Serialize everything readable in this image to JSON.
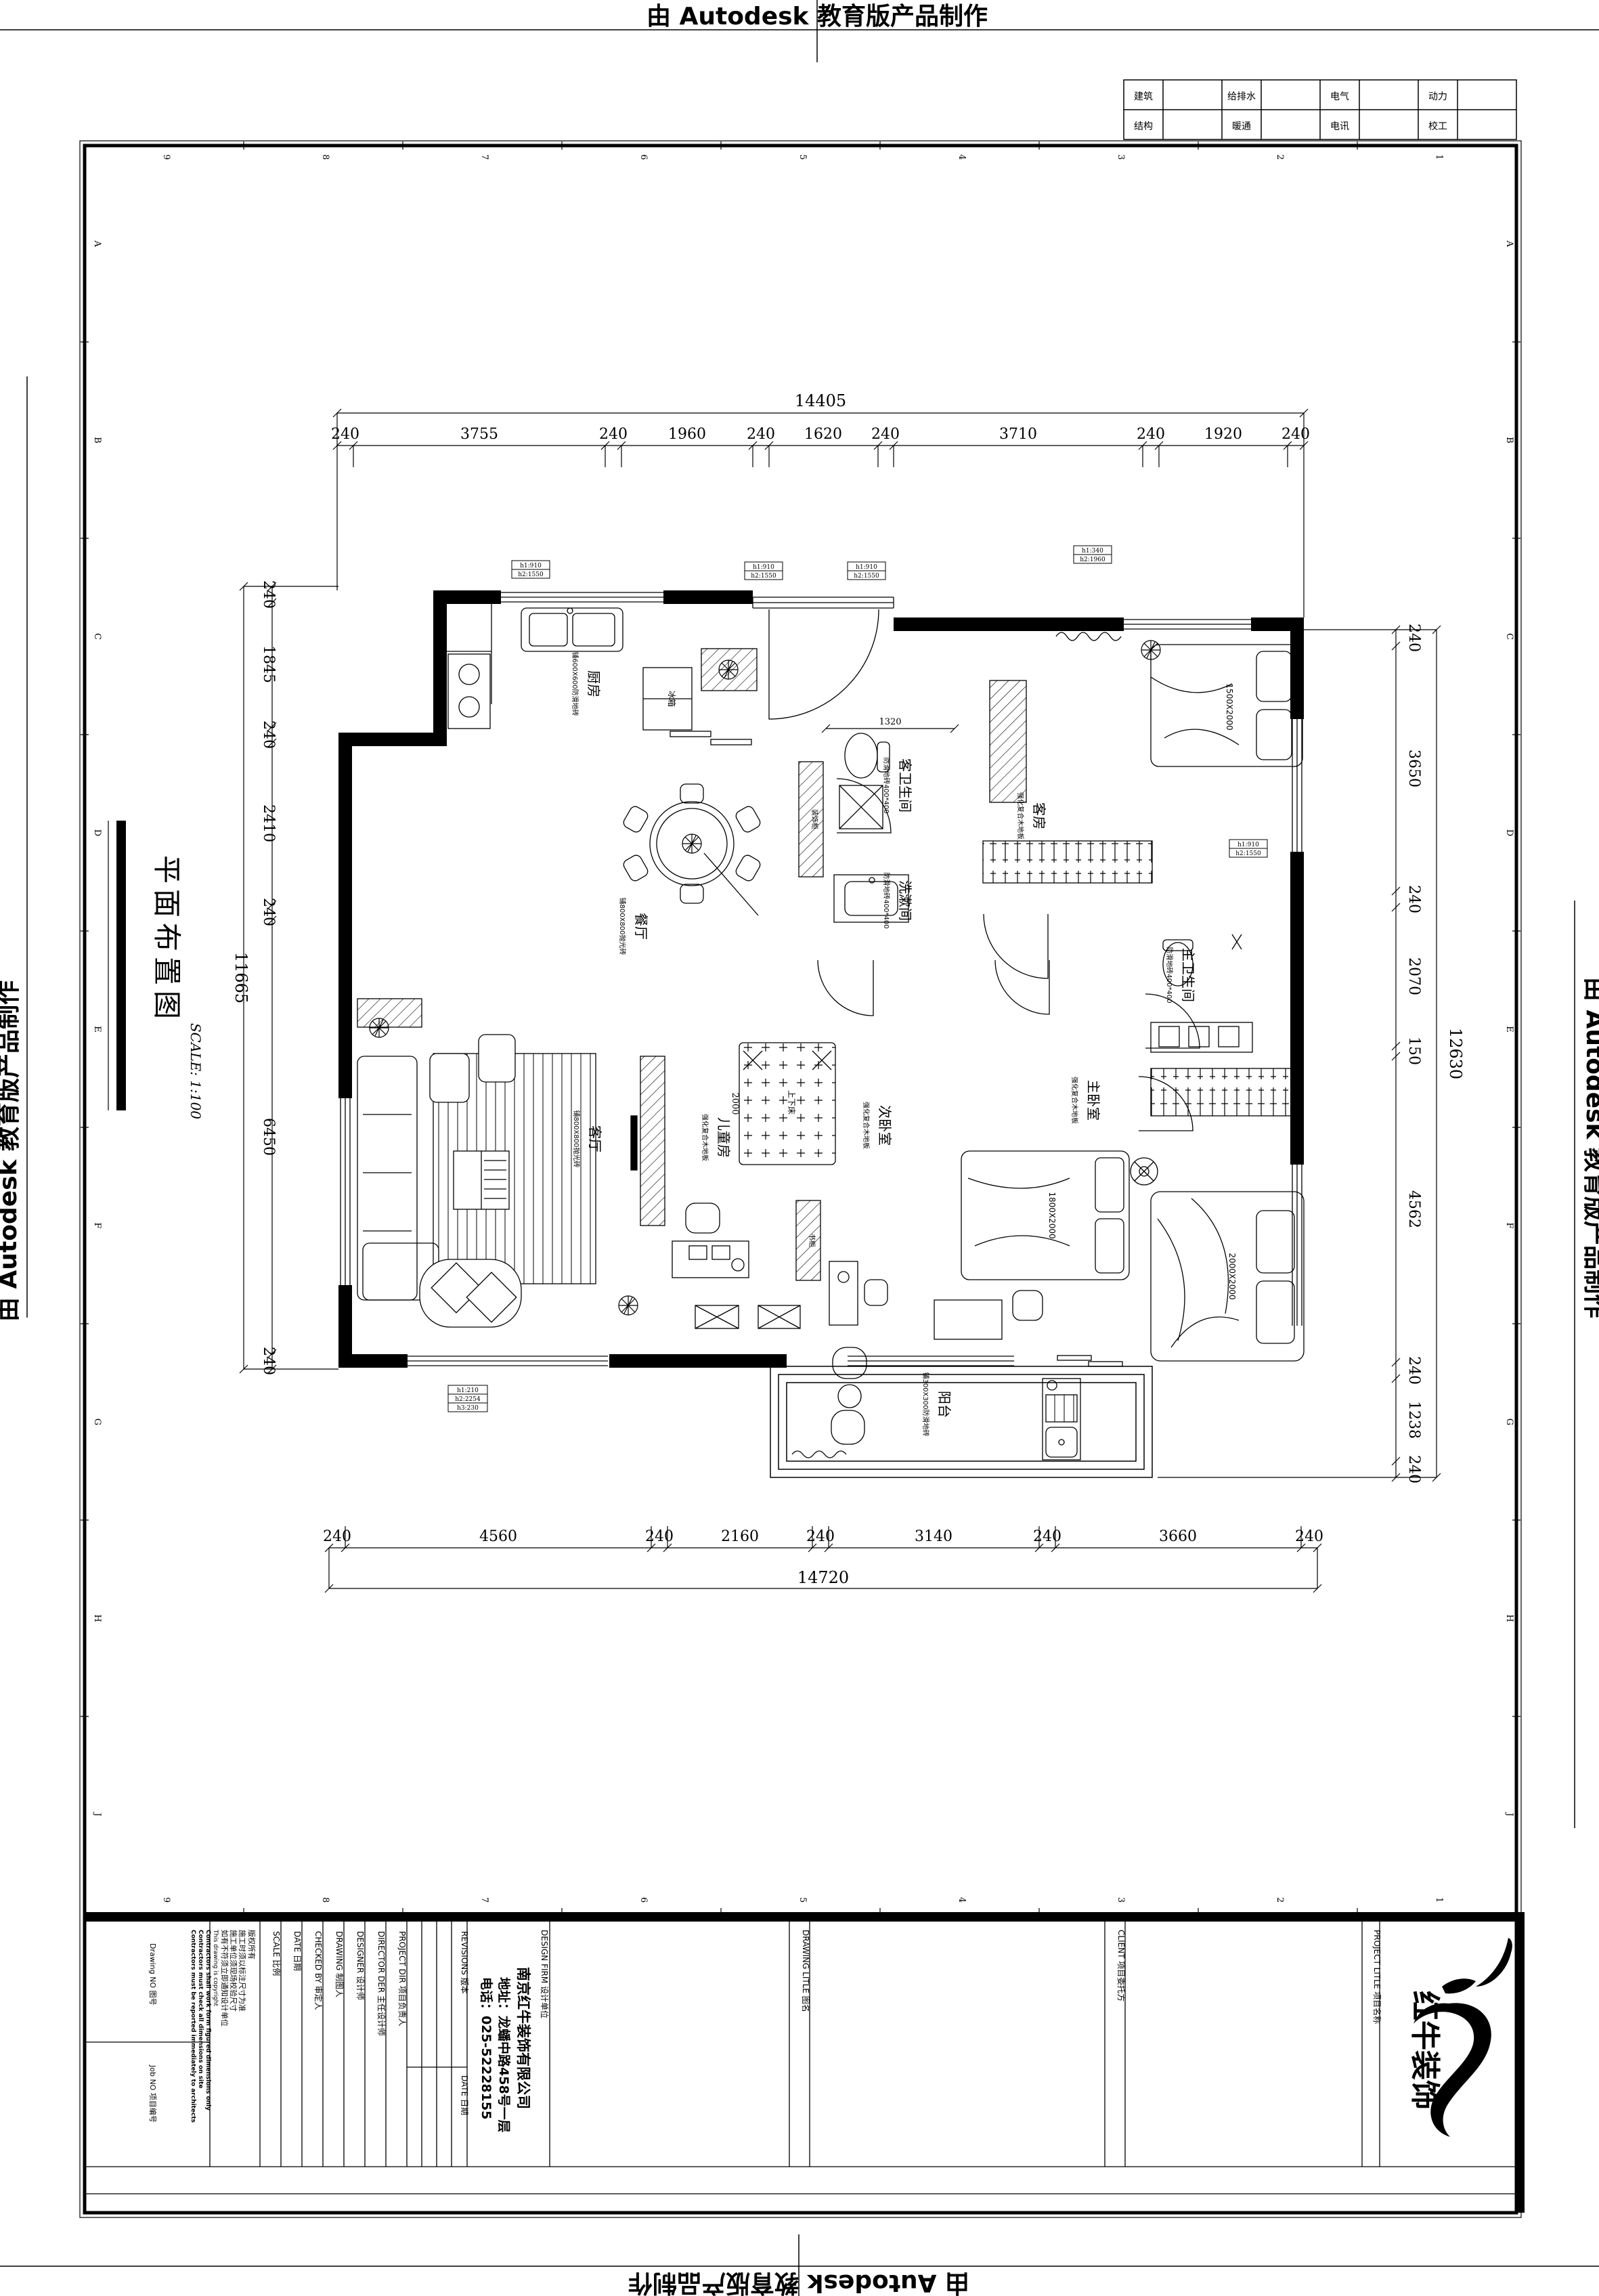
{
  "watermark": {
    "text": "由 Autodesk 教育版产品制作"
  },
  "sheet_title": {
    "name": "平面布置图",
    "scale": "SCALE: 1:100"
  },
  "discipline_table": {
    "row1": [
      "建筑",
      "给排水",
      "电气",
      "动力"
    ],
    "row2": [
      "结构",
      "暖通",
      "电讯",
      "校工"
    ]
  },
  "frame_grid": {
    "numbers": [
      "9",
      "8",
      "7",
      "6",
      "5",
      "4",
      "3",
      "2",
      "1"
    ],
    "letters": [
      "A",
      "B",
      "C",
      "D",
      "E",
      "F",
      "G",
      "H",
      "J"
    ]
  },
  "dimensions": {
    "top": {
      "segments": [
        "240",
        "3755",
        "240",
        "1960",
        "240",
        "1620",
        "240",
        "3710",
        "240",
        "1920",
        "240"
      ],
      "total": "14405"
    },
    "bottom": {
      "segments": [
        "240",
        "4560",
        "240",
        "2160",
        "240",
        "3140",
        "240",
        "3660",
        "240"
      ],
      "total": "14720"
    },
    "left": {
      "segments": [
        "240",
        "1845",
        "240",
        "2410",
        "240",
        "6450",
        "240"
      ],
      "total": "11665"
    },
    "right": {
      "segments": [
        "240",
        "3650",
        "240",
        "2070",
        "150",
        "4562",
        "240",
        "1238",
        "240"
      ],
      "total": "12630"
    },
    "interior": {
      "d1": "1320",
      "d2": "2000"
    }
  },
  "rooms": {
    "kitchen": {
      "name": "厨房",
      "finish": "铺600X600防滑地砖"
    },
    "dining": {
      "name": "餐厅",
      "finish": "铺800X800抛光砖"
    },
    "living": {
      "name": "客厅",
      "finish": "铺800X800抛光砖"
    },
    "children": {
      "name": "儿童房",
      "finish": "强化复合木地板"
    },
    "second_bed": {
      "name": "次卧室",
      "finish": "强化复合木地板"
    },
    "master_bed": {
      "name": "主卧室",
      "finish": "强化复合木地板"
    },
    "guest_bed": {
      "name": "客房",
      "finish": "强化复合木地板"
    },
    "guest_bath": {
      "name": "客卫生间",
      "finish": "防滑地砖400*400"
    },
    "washroom": {
      "name": "洗漱间",
      "finish": "防滑地砖400*400"
    },
    "master_bath": {
      "name": "主卫生间",
      "finish": "防滑地砖400*400"
    },
    "balcony": {
      "name": "阳台",
      "finish": "铺300X300防滑地砖"
    }
  },
  "furniture": {
    "fridge": "冰箱",
    "deco_cabinet": "装饰柜",
    "bookcase": "书柜",
    "bunk_bed": "上下床",
    "guest_bed_size": "1500X2000",
    "second_bed_size": "1800X2000",
    "master_bed_size": "2000X2000"
  },
  "window_tags": {
    "tag1": {
      "l1": "h1:910",
      "l2": "h2:1550"
    },
    "tag2": {
      "l1": "h1:910",
      "l2": "h2:1550"
    },
    "tag3": {
      "l1": "h1:910",
      "l2": "h2:1550"
    },
    "tag4": {
      "l1": "h1:340",
      "l2": "h2:1960"
    },
    "tag5": {
      "l1": "h1:910",
      "l2": "h2:1550"
    },
    "tag6": {
      "l1": "h1:210",
      "l2": "h2:2254",
      "l3": "h3:230"
    }
  },
  "title_block": {
    "copyright": "版权所有",
    "note_cn_1": "施工时须以标注尺寸为准",
    "note_cn_2": "施工单位须现场校验尺寸",
    "note_cn_3": "如有不符须立即通知设计单位",
    "note_en_1": "This drawing is copyright",
    "note_en_2": "Contractors shall work form figured dimensions only",
    "note_en_3": "Contractors must check all dimensions on site",
    "note_en_4": "Contractors must be reported immediately to architects",
    "drawing_no": "Drawing NO 图号",
    "job_no": "Job NO 项目编号",
    "scale_label": "SCALE 比例",
    "date_label": "DATE 日期",
    "checked_label": "CHECKED BY 审定人",
    "drawing_label": "DRAWING 制图人",
    "designer_label": "DESIGNER 设计师",
    "director_label": "DIRECTOR DER 主任设计师",
    "project_dir_label": "PROJECT DIR 项目负责人",
    "revisions_label": "REVISIONS 版本",
    "rev_date_label": "DATE 日期",
    "design_firm_label": "DESIGN FIRM 设计单位",
    "firm_name": "南京红牛装饰有限公司",
    "firm_address": "地址：龙蟠中路458号一层",
    "firm_phone": "电话：025-52228155",
    "drawing_title_label": "DRAWING LITLE 图名",
    "client_label": "CLIENT 项目委托方",
    "project_title_label": "PROJECT LITLE 项目名称",
    "logo_text": "红牛装饰"
  }
}
